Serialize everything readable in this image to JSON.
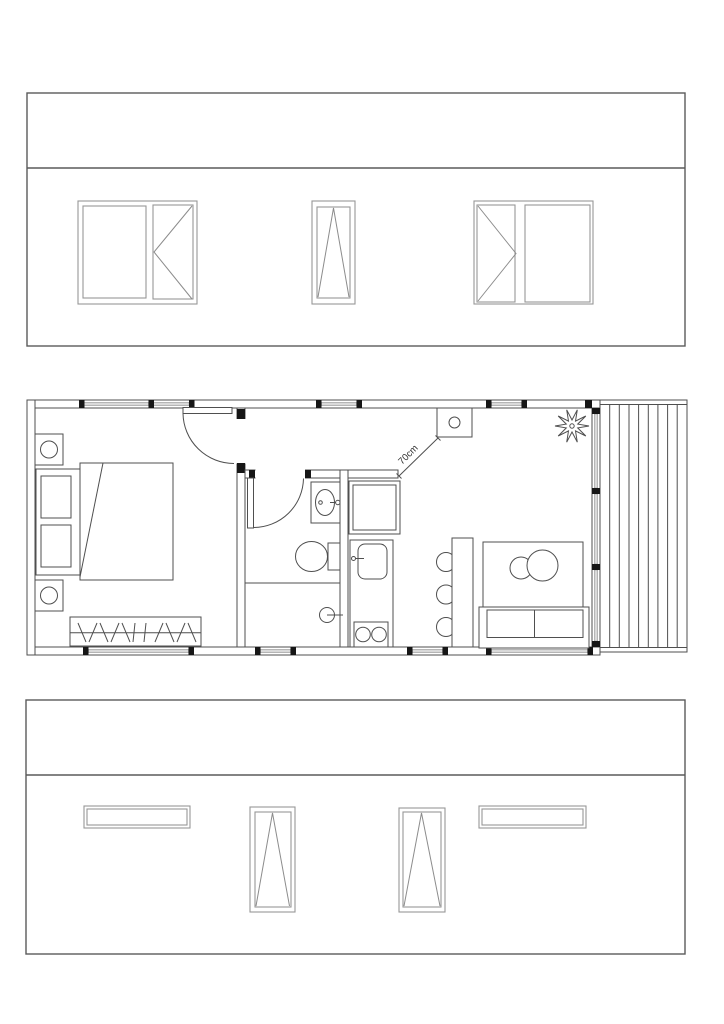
{
  "floor_plan": {
    "dimension_label": "70cm",
    "rooms": [
      "bedroom",
      "bathroom",
      "kitchen-nook",
      "living-area",
      "deck"
    ],
    "fixtures": [
      "double-bed",
      "nightstand-lamp",
      "nightstand-lamp",
      "wardrobe-hangers",
      "hinged-door",
      "hinged-door",
      "washbasin",
      "toilet",
      "shower-drain",
      "refrigerator",
      "kitchen-sink",
      "cooktop-2-burner",
      "dining-table",
      "three-chairs",
      "rug",
      "round-coffee-tables",
      "sofa",
      "potted-plant",
      "corner-stove-unit",
      "glazed-wall",
      "timber-deck"
    ]
  },
  "elevations": {
    "top": {
      "windows": [
        "double-casement-side-opening",
        "narrow-tilt-window",
        "double-casement-side-opening"
      ]
    },
    "bottom": {
      "windows": [
        "fixed-strip-window",
        "tall-tilt-window",
        "tall-tilt-window",
        "fixed-strip-window"
      ]
    }
  },
  "colors": {
    "line": "#4f4f4f",
    "cap": "#161616",
    "glazing": "#d9d9d9",
    "frame": "#979797",
    "elev": "#5a5a5a",
    "bg": "#ffffff"
  }
}
